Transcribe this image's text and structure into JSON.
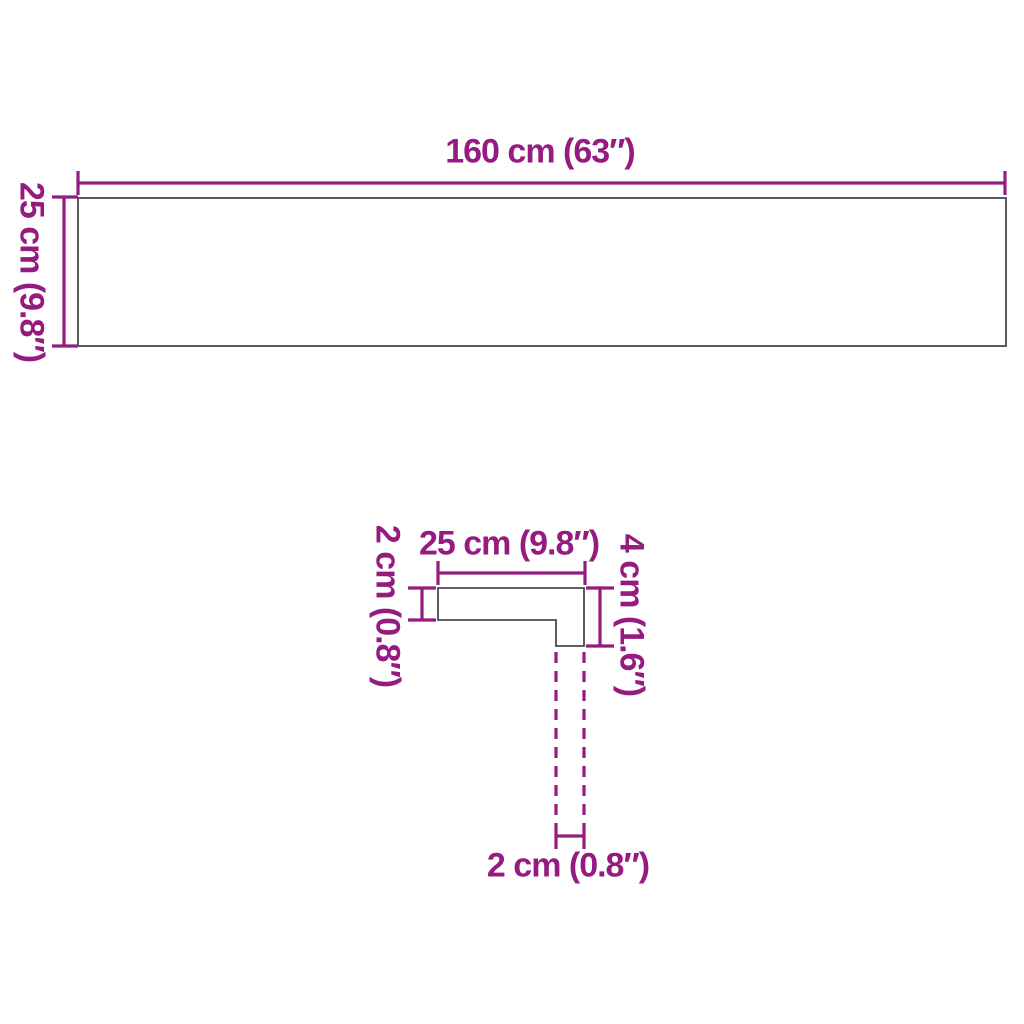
{
  "colors": {
    "dimension": "#951B81",
    "outline": "#4A4A4A",
    "background": "#FFFFFF"
  },
  "top_view": {
    "width_label": "160 cm (63″)",
    "depth_label": "25 cm (9.8″)"
  },
  "side_profile": {
    "width_label": "25 cm (9.8″)",
    "thickness_label": "2 cm (0.8″)",
    "height_label": "4 cm (1.6″)",
    "nose_width_label": "2 cm (0.8″)"
  }
}
